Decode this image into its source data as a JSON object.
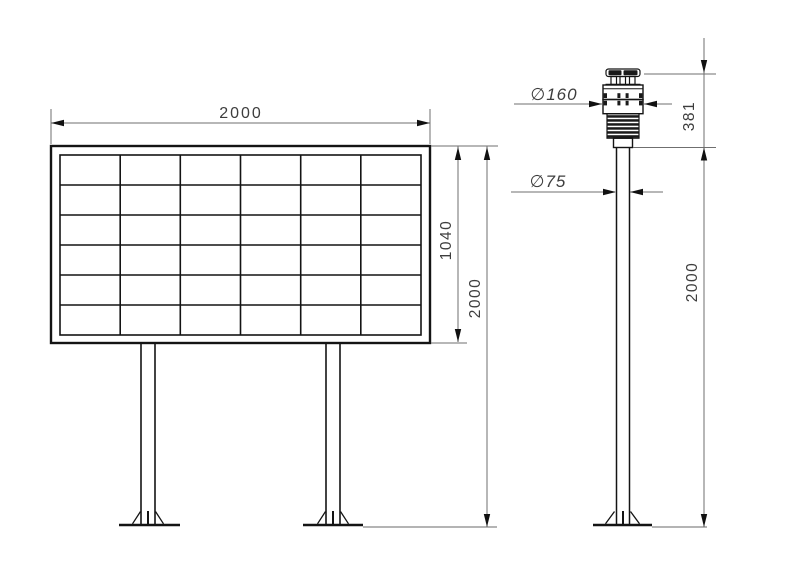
{
  "colors": {
    "background": "#ffffff",
    "object_line": "#141414",
    "dimension_line": "#6f6f6f",
    "dimension_text": "#3d3d3d",
    "ground_line": "#9c9c9c"
  },
  "board_view": {
    "description": "display board front view on two legs",
    "grid": {
      "rows": 6,
      "cols": 6
    },
    "dims": {
      "width": {
        "label": "2000"
      },
      "panel_height": {
        "label": "1040"
      },
      "total_height": {
        "label": "2000"
      }
    }
  },
  "station_view": {
    "description": "weather sensor on pole side view",
    "dims": {
      "sensor_diameter": {
        "label": "∅160"
      },
      "pole_diameter": {
        "label": "∅75"
      },
      "sensor_height": {
        "label": "381"
      },
      "pole_height": {
        "label": "2000"
      }
    }
  }
}
